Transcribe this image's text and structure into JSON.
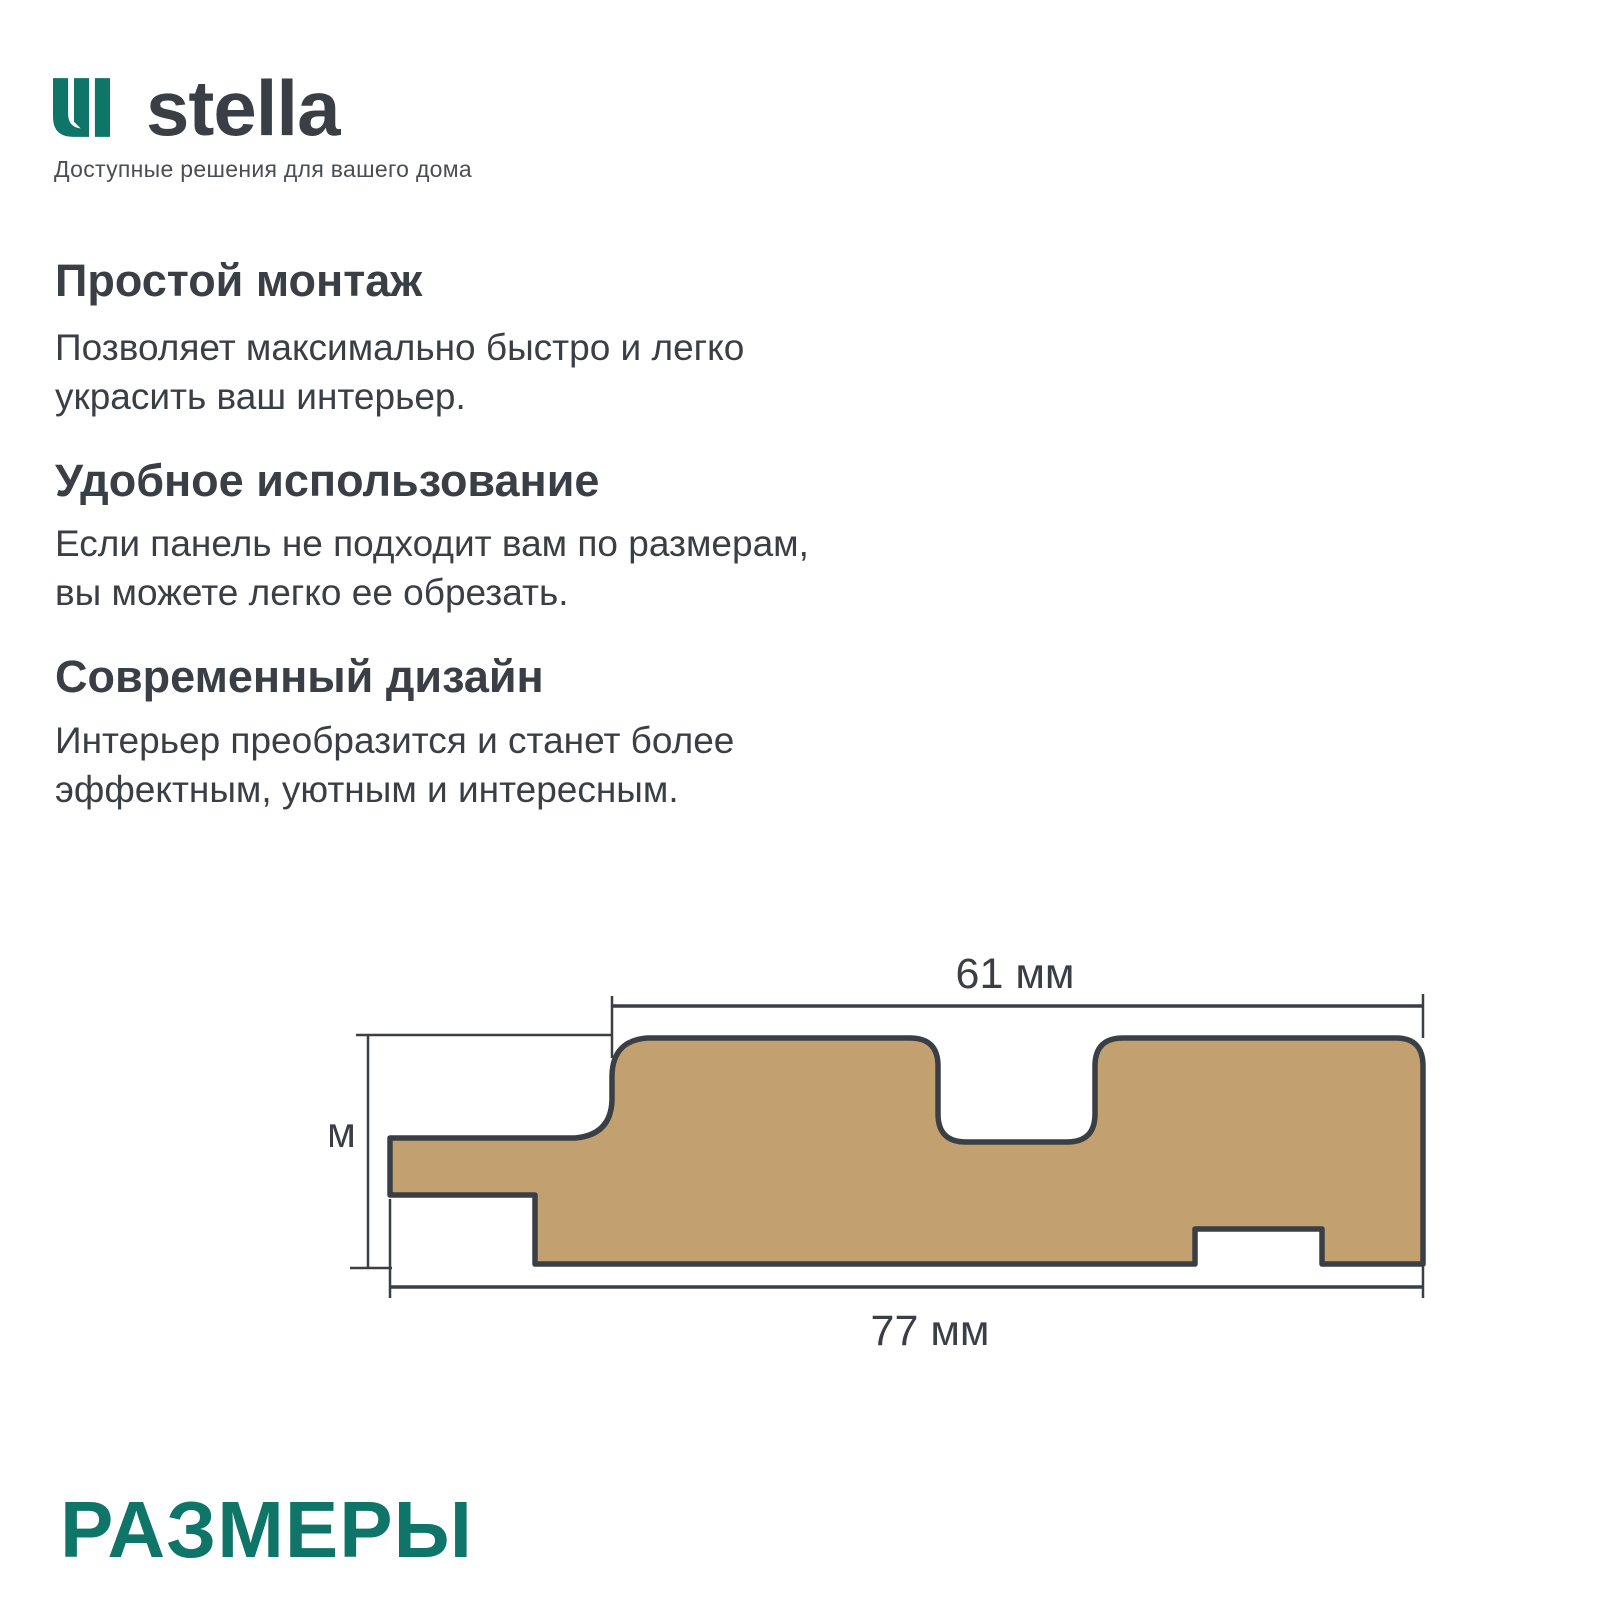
{
  "colors": {
    "teal": "#0F7568",
    "dark_text": "#3A3F46",
    "tagline_gray": "#494E54",
    "panel_fill": "#C2A06F",
    "panel_outline": "#3A3F46"
  },
  "logo": {
    "brand": "stella",
    "tagline": "Доступные решения для вашего дома"
  },
  "sections": [
    {
      "heading": "Простой монтаж",
      "lines": [
        "Позволяет максимально быстро и легко",
        "украсить ваш интерьер."
      ]
    },
    {
      "heading": "Удобное использование",
      "lines": [
        "Если панель не подходит вам по размерам,",
        "вы можете легко ее обрезать."
      ]
    },
    {
      "heading": "Современный дизайн",
      "lines": [
        "Интерьер преобразится и станет более",
        "эффектным, уютным и интересным."
      ]
    }
  ],
  "diagram": {
    "dim_top_label": "61 мм",
    "dim_left_label": "16 мм",
    "dim_bottom_label": "77 мм"
  },
  "footer": {
    "title": "РАЗМЕРЫ"
  }
}
